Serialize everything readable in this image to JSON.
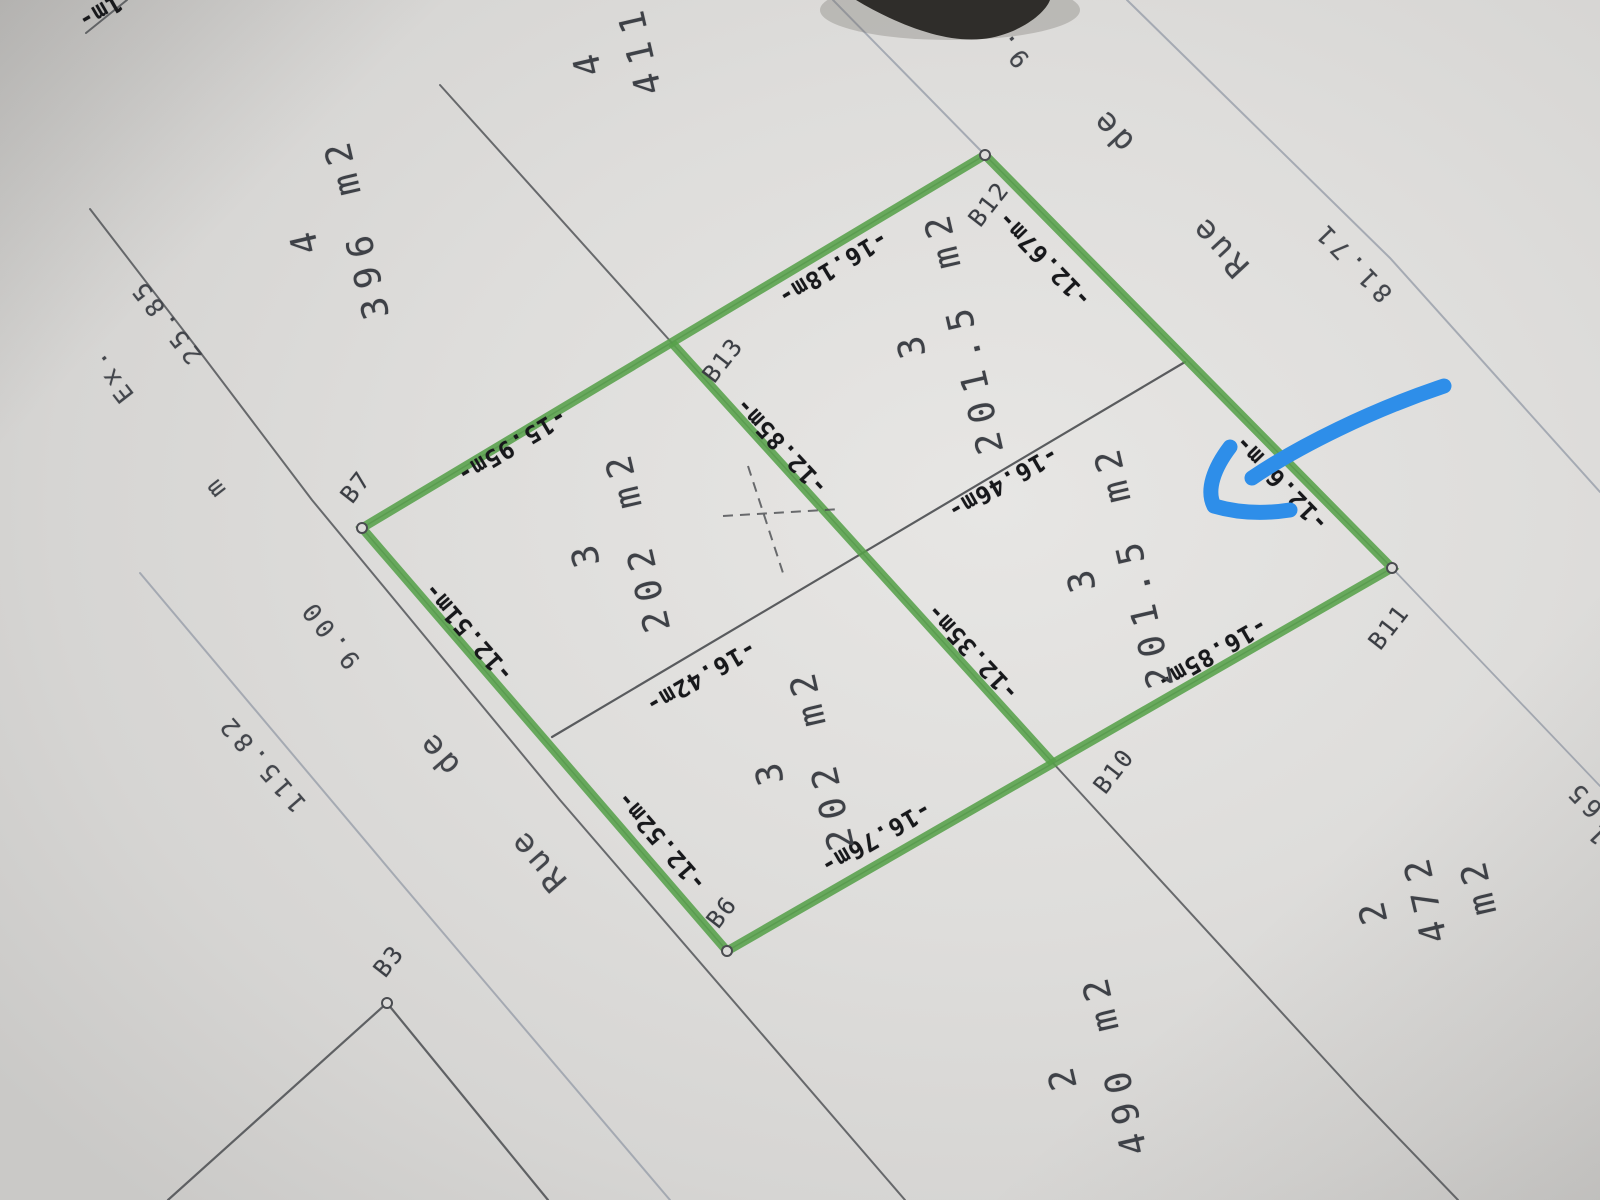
{
  "palette": {
    "paper": "#dcdbd9",
    "ink": "#4a4c50",
    "faint": "#9ba1ab",
    "green": "#56a04a",
    "blue": "#2e8ee9",
    "blob": "#2f2d2a"
  },
  "plan": {
    "green": {
      "outline": [
        [
          362,
          528
        ],
        [
          985,
          155
        ],
        [
          1392,
          568
        ],
        [
          727,
          951
        ]
      ],
      "divider": [
        [
          672,
          343
        ],
        [
          1053,
          763
        ]
      ],
      "stroke_width": 9
    },
    "lines": [
      {
        "name": "inner-divider-line",
        "color": "ink",
        "width": 2.2,
        "opacity": 0.9,
        "points": [
          [
            552,
            737
          ],
          [
            1185,
            362
          ]
        ]
      },
      {
        "name": "street-line-sw",
        "color": "faint",
        "width": 2,
        "opacity": 0.85,
        "points": [
          [
            140,
            573
          ],
          [
            400,
            882
          ],
          [
            670,
            1200
          ]
        ]
      },
      {
        "name": "boundary-line-nw",
        "color": "ink",
        "width": 2,
        "opacity": 0.8,
        "points": [
          [
            90,
            209
          ],
          [
            200,
            352
          ],
          [
            312,
            500
          ],
          [
            560,
            800
          ],
          [
            905,
            1200
          ]
        ]
      },
      {
        "name": "divider-parcels-4",
        "color": "ink",
        "width": 2,
        "opacity": 0.8,
        "points": [
          [
            440,
            85
          ],
          [
            672,
            343
          ]
        ]
      },
      {
        "name": "street-line-ne-inner",
        "color": "faint",
        "width": 2,
        "opacity": 0.85,
        "points": [
          [
            833,
            0
          ],
          [
            985,
            155
          ]
        ]
      },
      {
        "name": "street-line-ne-outer",
        "color": "faint",
        "width": 2,
        "opacity": 0.85,
        "points": [
          [
            1127,
            0
          ],
          [
            1390,
            258
          ],
          [
            1600,
            492
          ]
        ]
      },
      {
        "name": "boundary-line-se",
        "color": "faint",
        "width": 1.8,
        "opacity": 0.9,
        "points": [
          [
            1392,
            568
          ],
          [
            1600,
            786
          ]
        ]
      },
      {
        "name": "boundary-line-b10",
        "color": "ink",
        "width": 2,
        "opacity": 0.8,
        "points": [
          [
            1053,
            763
          ],
          [
            1360,
            1098
          ],
          [
            1458,
            1200
          ]
        ]
      },
      {
        "name": "boundary-line-b3-left",
        "color": "ink",
        "width": 2.2,
        "opacity": 0.85,
        "points": [
          [
            387,
            1003
          ],
          [
            168,
            1200
          ]
        ]
      },
      {
        "name": "boundary-line-b3-right",
        "color": "ink",
        "width": 2.2,
        "opacity": 0.85,
        "points": [
          [
            387,
            1003
          ],
          [
            548,
            1200
          ]
        ]
      },
      {
        "name": "edge-fragment-line",
        "color": "ink",
        "width": 2,
        "opacity": 0.8,
        "points": [
          [
            86,
            33
          ],
          [
            127,
            0
          ]
        ]
      }
    ],
    "cross": [
      [
        [
          723,
          516
        ],
        [
          841,
          509
        ]
      ],
      [
        [
          748,
          466
        ],
        [
          783,
          573
        ]
      ]
    ],
    "dots": [
      [
        362,
        528
      ],
      [
        985,
        155
      ],
      [
        1392,
        568
      ],
      [
        727,
        951
      ],
      [
        387,
        1003
      ]
    ],
    "blob": "M856,0 L1050,0 C1044,16 1014,36 982,39 C944,43 896,24 856,0 Z",
    "arrow": {
      "shaft": "M1444,386 C1372,410 1299,446 1252,478",
      "head": "M1230,447 C1214,468 1206,490 1214,506 C1238,513 1264,514 1290,510",
      "width": 15
    },
    "labels": [
      {
        "name": "measure-label",
        "kind": "measure",
        "text": "-15.95m-",
        "x": 512,
        "y": 446,
        "rot": 149
      },
      {
        "name": "measure-label",
        "kind": "measure",
        "text": "-16.18m-",
        "x": 833,
        "y": 268,
        "rot": 149
      },
      {
        "name": "measure-label",
        "kind": "measure",
        "text": "-12.67m-",
        "x": 1044,
        "y": 259,
        "rot": 226
      },
      {
        "name": "measure-label",
        "kind": "measure",
        "text": "-12.67m-",
        "x": 1281,
        "y": 483,
        "rot": 226
      },
      {
        "name": "measure-label",
        "kind": "measure",
        "text": "-12.51m-",
        "x": 468,
        "y": 632,
        "rot": 229
      },
      {
        "name": "measure-label",
        "kind": "measure",
        "text": "-12.52m-",
        "x": 661,
        "y": 841,
        "rot": 229
      },
      {
        "name": "measure-label",
        "kind": "measure",
        "text": "-12.85m-",
        "x": 781,
        "y": 446,
        "rot": 227
      },
      {
        "name": "measure-label",
        "kind": "measure",
        "text": "-12.35m-",
        "x": 972,
        "y": 652,
        "rot": 227
      },
      {
        "name": "measure-label",
        "kind": "measure",
        "text": "-16.42m-",
        "x": 701,
        "y": 677,
        "rot": 150
      },
      {
        "name": "measure-label",
        "kind": "measure",
        "text": "-16.46m-",
        "x": 1003,
        "y": 483,
        "rot": 150
      },
      {
        "name": "measure-label",
        "kind": "measure",
        "text": "-16.76m-",
        "x": 876,
        "y": 838,
        "rot": 150
      },
      {
        "name": "measure-label",
        "kind": "measure",
        "text": "-16.85m-",
        "x": 1212,
        "y": 654,
        "rot": 150
      },
      {
        "name": "measure-label-fragment",
        "kind": "measure",
        "text": "1m-",
        "x": 100,
        "y": 12,
        "rot": 150
      },
      {
        "name": "parcel-area-label",
        "kind": "area",
        "text": "3\n202 m2",
        "x": 612,
        "y": 545,
        "rot": 257
      },
      {
        "name": "parcel-area-label",
        "kind": "area",
        "text": "3\n201.5 m2",
        "x": 938,
        "y": 336,
        "rot": 257
      },
      {
        "name": "parcel-area-label",
        "kind": "area",
        "text": "3\n202 m2",
        "x": 796,
        "y": 763,
        "rot": 257
      },
      {
        "name": "parcel-area-label",
        "kind": "area",
        "text": "3\n201.5 m2",
        "x": 1108,
        "y": 570,
        "rot": 257
      },
      {
        "name": "parcel-area-label",
        "kind": "area",
        "text": "4\n396 m2",
        "x": 331,
        "y": 232,
        "rot": 257
      },
      {
        "name": "parcel-area-label",
        "kind": "area",
        "text": "4\n411",
        "x": 614,
        "y": 54,
        "rot": 257
      },
      {
        "name": "parcel-area-label",
        "kind": "area",
        "text": "2\n472 m2",
        "x": 1426,
        "y": 896,
        "rot": 257
      },
      {
        "name": "parcel-area-label",
        "kind": "area",
        "text": "2\n490 m2",
        "x": 1089,
        "y": 1068,
        "rot": 257
      },
      {
        "name": "street-name-label",
        "kind": "street",
        "text": "Rue",
        "x": 1219,
        "y": 247,
        "rot": 227
      },
      {
        "name": "street-name-label",
        "kind": "street",
        "text": "de",
        "x": 1112,
        "y": 131,
        "rot": 227
      },
      {
        "name": "street-name-label",
        "kind": "street",
        "text": "Rue",
        "x": 537,
        "y": 861,
        "rot": 229
      },
      {
        "name": "street-name-label",
        "kind": "street",
        "text": "de",
        "x": 438,
        "y": 754,
        "rot": 229
      },
      {
        "name": "dimension-label",
        "kind": "dim",
        "text": "25.85",
        "x": 166,
        "y": 321,
        "rot": 232
      },
      {
        "name": "dimension-label",
        "kind": "dim",
        "text": "115.82",
        "x": 262,
        "y": 763,
        "rot": 229
      },
      {
        "name": "dimension-label",
        "kind": "dim",
        "text": "81.71",
        "x": 1353,
        "y": 262,
        "rot": 226
      },
      {
        "name": "dimension-label",
        "kind": "dim",
        "text": "9.00",
        "x": 330,
        "y": 634,
        "rot": 232
      },
      {
        "name": "dimension-label",
        "kind": "dim",
        "text": "9.00",
        "x": 999,
        "y": 33,
        "rot": 231
      },
      {
        "name": "dimension-label",
        "kind": "dim",
        "text": "65",
        "x": 1584,
        "y": 799,
        "rot": 226
      },
      {
        "name": "dimension-label",
        "kind": "dim",
        "text": "Ex.",
        "x": 110,
        "y": 376,
        "rot": 232
      },
      {
        "name": "dimension-label",
        "kind": "dim",
        "text": "m",
        "x": 214,
        "y": 487,
        "rot": 232
      },
      {
        "name": "dimension-label-fragment",
        "kind": "dim",
        "text": "1",
        "x": 1597,
        "y": 833,
        "rot": 226
      },
      {
        "name": "survey-point-label",
        "kind": "point",
        "text": "B7",
        "x": 356,
        "y": 487,
        "rot": -52
      },
      {
        "name": "survey-point-label",
        "kind": "point",
        "text": "B13",
        "x": 723,
        "y": 360,
        "rot": -52
      },
      {
        "name": "survey-point-label",
        "kind": "point",
        "text": "B12",
        "x": 989,
        "y": 204,
        "rot": -52
      },
      {
        "name": "survey-point-label",
        "kind": "point",
        "text": "B11",
        "x": 1389,
        "y": 627,
        "rot": -52
      },
      {
        "name": "survey-point-label",
        "kind": "point",
        "text": "B10",
        "x": 1114,
        "y": 771,
        "rot": -52
      },
      {
        "name": "survey-point-label",
        "kind": "point",
        "text": "B6",
        "x": 722,
        "y": 912,
        "rot": -52
      },
      {
        "name": "survey-point-label",
        "kind": "point",
        "text": "B3",
        "x": 389,
        "y": 961,
        "rot": -52
      }
    ]
  }
}
